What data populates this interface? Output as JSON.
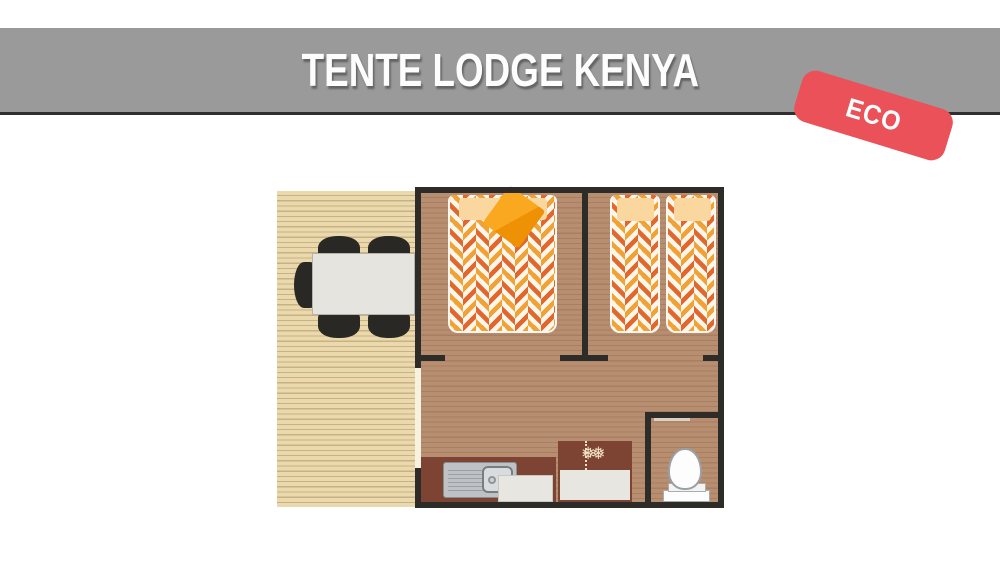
{
  "header": {
    "title": "TENTE LODGE KENYA"
  },
  "badge": {
    "label": "ECO"
  },
  "icons": {
    "snowflake_glyph": "❅❅",
    "furniture": [
      "dining-table",
      "dining-chair",
      "double-bed",
      "single-bed",
      "pillow",
      "cushion",
      "kitchen-sink",
      "kitchen-appliance",
      "fridge-snowflake",
      "toilet",
      "deck-planks",
      "door-opening"
    ]
  },
  "colors": {
    "banner": "#9b9a9b",
    "banner_line": "#2f2f2f",
    "title_text": "#fdfdfd",
    "badge": "#ea5158",
    "badge_text": "#ffffff",
    "wall": "#2e2c29",
    "deck": "#ead9ad",
    "deck_line": "#c9b183",
    "floor": "#b88e71",
    "floor_line": "#a87f63",
    "counter": "#7d4434",
    "chevron_orange": "#f0a236",
    "chevron_dark_orange": "#e2672c",
    "chevron_white": "#fdf6ea",
    "pillow": "#fbd7a0",
    "cushion": "#f6a014",
    "table": "#e6e4de",
    "chair": "#292825",
    "appliance": "#e8e6e0",
    "cream": "#f2e2c0",
    "steel": "#bfc2c4"
  }
}
